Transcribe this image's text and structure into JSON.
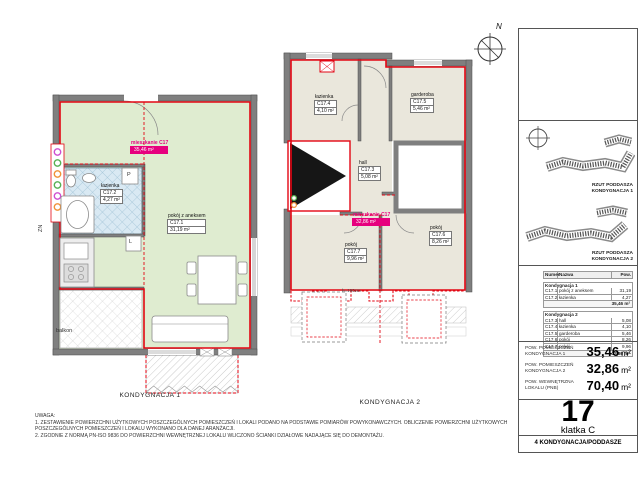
{
  "palette": {
    "red": "#e30613",
    "pink": "#e6007e",
    "wall_gray": "#7f7f7f",
    "floor_green": "#dfecd0",
    "floor_beige": "#eae7dc",
    "bath_blue": "#d9e9f3"
  },
  "compass": {
    "label": "N"
  },
  "plan1": {
    "caption": "KONDYGNACJA 1",
    "apartment": {
      "name": "mieszkanie C17",
      "area": "35,46 m²"
    },
    "rooms": [
      {
        "name": "pokój z aneksem",
        "number": "C17.1",
        "area": "31,19 m²"
      },
      {
        "name": "łazienka",
        "number": "C17.2",
        "area": "4,27 m²"
      }
    ],
    "markers": {
      "washer": "P",
      "fridge": "L",
      "riser": "ZN",
      "balcony": "balkon"
    }
  },
  "plan2": {
    "caption": "KONDYGNACJA 2",
    "apartment": {
      "name": "mieszkanie C17",
      "area": "32,86 m²"
    },
    "rooms": [
      {
        "name": "łazienka",
        "number": "C17.4",
        "area": "4,10 m²"
      },
      {
        "name": "garderoba",
        "number": "C17.5",
        "area": "5,46 m²"
      },
      {
        "name": "hall",
        "number": "C17.3",
        "area": "5,08 m²"
      },
      {
        "name": "pokój",
        "number": "C17.7",
        "area": "9,96 m²"
      },
      {
        "name": "pokój",
        "number": "C17.6",
        "area": "8,26 m²"
      }
    ],
    "height_note": "h=190cm"
  },
  "sidebar": {
    "siteplans": [
      {
        "line1": "RZUT PODDASZA",
        "line2": "KONDYGNACJA 1"
      },
      {
        "line1": "RZUT PODDASZA",
        "line2": "KONDYGNACJA 2"
      }
    ],
    "table": {
      "headers": [
        "Numer",
        "Nazwa",
        "Pow."
      ],
      "groups": [
        {
          "title": "Kondygnacja 1",
          "rows": [
            [
              "C17.1",
              "pokój z aneksem",
              "31,19"
            ],
            [
              "C17.2",
              "łazienka",
              "4,27"
            ]
          ],
          "total": "35,46 m²"
        },
        {
          "title": "Kondygnacja 2",
          "rows": [
            [
              "C17.3",
              "hall",
              "5,08"
            ],
            [
              "C17.4",
              "łazienka",
              "4,10"
            ],
            [
              "C17.5",
              "garderoba",
              "5,46"
            ],
            [
              "C17.6",
              "pokój",
              "8,26"
            ],
            [
              "C17.7",
              "pokój",
              "9,96"
            ]
          ],
          "total": "32,86 m²"
        }
      ]
    },
    "areas": [
      {
        "label1": "POW. POMIESZCZEŃ",
        "label2": "KONDYGNACJA 1",
        "value": "35,46",
        "unit": "m²"
      },
      {
        "label1": "POW. POMIESZCZEŃ",
        "label2": "KONDYGNACJA 2",
        "value": "32,86",
        "unit": "m²"
      },
      {
        "label1": "POW. WEWNĘTRZNA",
        "label2": "LOKALU (PNB)",
        "value": "70,40",
        "unit": "m²"
      }
    ],
    "apartment": {
      "number": "17",
      "staircase": "klatka C",
      "floor": "4 KONDYGNACJA/PODDASZE"
    }
  },
  "notes": {
    "title": "UWAGA:",
    "lines": [
      "1. ZESTAWIENIE POWIERZCHNI UŻYTKOWYCH POSZCZEGÓLNYCH POMIESZCZEŃ I LOKALI PODANO NA PODSTAWIE POMIARÓW POWYKONAWCZYCH. OBLICZENIE POWIERZCHNI UŻYTKOWYCH POSZCZEGÓLNYCH POMIESZCZEŃ I LOKALU WYKONANO DLA DANEJ ARANŻACJI.",
      "2. ZGODNIE Z NORMĄ PN-ISO 9836 DO POWIERZCHNI WEWNĘTRZNEJ LOKALU WLICZONO ŚCIANKI DZIAŁOWE NADAJĄCE SIĘ DO DEMONTAŻU."
    ]
  }
}
